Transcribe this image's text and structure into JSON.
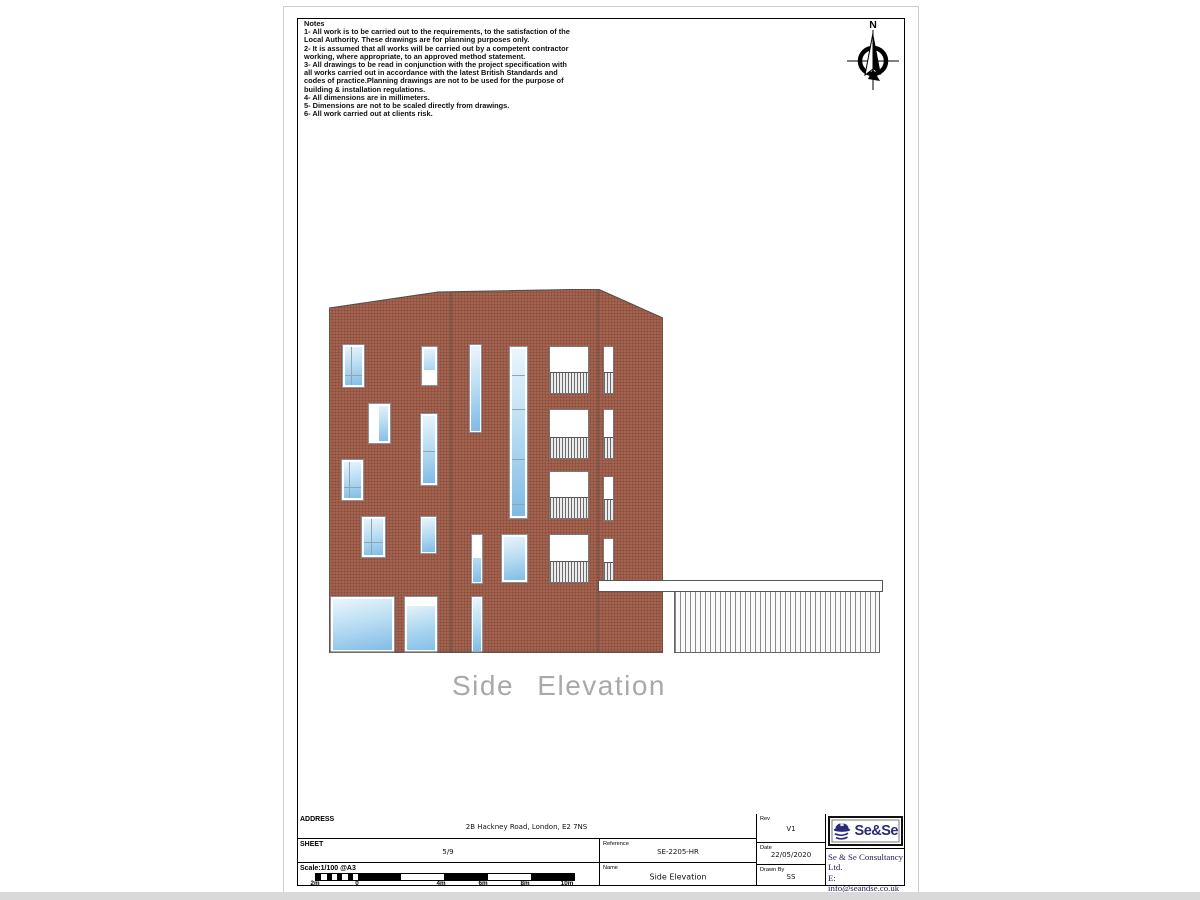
{
  "sheet": {
    "north_label": "N",
    "caption": "Side Elevation",
    "notes": {
      "title": "Notes",
      "lines": [
        "1- All work is to be carried out to the requirements, to the satisfaction of the",
        "Local Authority. These drawings are for planning purposes only.",
        "2- It is assumed that all works will be carried out by a competent contractor",
        "working, where appropriate, to an approved method statement.",
        "3- All drawings to be read in conjunction with the project specification with",
        "all works carried out in accordance with the latest British Standards and",
        "codes of practice.Planning drawings are not to be used for the purpose of",
        "building & installation regulations.",
        "4- All dimensions are in millimeters.",
        "5- Dimensions are not to be scaled directly from drawings.",
        "6- All work carried out at clients risk."
      ]
    }
  },
  "title_block": {
    "address_label": "ADDRESS",
    "address_value": "2B Hackney Road, London, E2 7NS",
    "sheet_label": "SHEET",
    "sheet_value": "5/9",
    "scale_label": "Scale:1/100 @A3",
    "reference_label": "Reference",
    "reference_value": "SE-2205-HR",
    "name_label": "Name",
    "name_value": "Side Elevation",
    "rev_label": "Rev",
    "rev_value": "V1",
    "date_label": "Date",
    "date_value": "22/05/2020",
    "drawn_label": "Drawn By",
    "drawn_value": "SS"
  },
  "company": {
    "logo_text": "Se&Se",
    "name": "Se & Se Consultancy Ltd.",
    "email": "E: info@seandse.co.uk",
    "mobile": "M: +44 (0) 7404765500",
    "web": "W: www.seandse.co.uk"
  },
  "scalebar": {
    "ticks": [
      {
        "t": "2m",
        "x": 0
      },
      {
        "t": "0",
        "x": 42
      },
      {
        "t": "4m",
        "x": 126
      },
      {
        "t": "6m",
        "x": 168
      },
      {
        "t": "8m",
        "x": 210
      },
      {
        "t": "10m",
        "x": 252
      }
    ]
  },
  "drawing": {
    "colors": {
      "brick": "#a5634f",
      "glass": "#8fc3e9",
      "navy": "#2a2a78"
    },
    "elements": [
      {
        "t": "glass",
        "x": 13,
        "y": 55,
        "w": 23,
        "h": 44,
        "v": [
          0.33
        ],
        "hd": [
          0.68
        ]
      },
      {
        "t": "glass",
        "x": 92,
        "y": 57,
        "w": 17,
        "h": 40,
        "wb": 14
      },
      {
        "t": "glass",
        "x": 39,
        "y": 114,
        "w": 23,
        "h": 41,
        "wl": 9
      },
      {
        "t": "glass",
        "x": 91,
        "y": 124,
        "w": 18,
        "h": 73,
        "hd": [
          0.5
        ]
      },
      {
        "t": "glass",
        "x": 12,
        "y": 170,
        "w": 23,
        "h": 42,
        "v": [
          0.3
        ],
        "hd": [
          0.65
        ]
      },
      {
        "t": "glass",
        "x": 32,
        "y": 227,
        "w": 25,
        "h": 42,
        "v": [
          0.35
        ],
        "hd": [
          0.6
        ]
      },
      {
        "t": "glass",
        "x": 91,
        "y": 227,
        "w": 17,
        "h": 38
      },
      {
        "t": "glass",
        "x": 1,
        "y": 307,
        "w": 65,
        "h": 57
      },
      {
        "t": "door",
        "x": 75,
        "y": 307,
        "w": 34,
        "h": 57
      },
      {
        "t": "glass",
        "x": 140,
        "y": 55,
        "w": 13,
        "h": 89
      },
      {
        "t": "glass",
        "x": 180,
        "y": 57,
        "w": 19,
        "h": 173,
        "hd": [
          0.16,
          0.36,
          0.65,
          0.91
        ]
      },
      {
        "t": "glass",
        "x": 142,
        "y": 245,
        "w": 12,
        "h": 50,
        "wt": 22
      },
      {
        "t": "glass",
        "x": 142,
        "y": 307,
        "w": 12,
        "h": 57
      },
      {
        "t": "glass",
        "x": 172,
        "y": 245,
        "w": 27,
        "h": 49
      },
      {
        "t": "balcony",
        "x": 220,
        "y": 57,
        "w": 40,
        "h": 48,
        "rail": 20
      },
      {
        "t": "balcony",
        "x": 220,
        "y": 120,
        "w": 40,
        "h": 50,
        "rail": 20
      },
      {
        "t": "balcony",
        "x": 220,
        "y": 182,
        "w": 40,
        "h": 48,
        "rail": 20
      },
      {
        "t": "balcony",
        "x": 220,
        "y": 245,
        "w": 40,
        "h": 49,
        "rail": 20
      },
      {
        "t": "juliet",
        "x": 274,
        "y": 57,
        "w": 11,
        "h": 48,
        "rail": 20
      },
      {
        "t": "juliet",
        "x": 274,
        "y": 120,
        "w": 11,
        "h": 50,
        "rail": 20
      },
      {
        "t": "juliet",
        "x": 274,
        "y": 187,
        "w": 11,
        "h": 45,
        "rail": 20
      },
      {
        "t": "juliet",
        "x": 274,
        "y": 249,
        "w": 11,
        "h": 45,
        "rail": 19
      }
    ]
  }
}
